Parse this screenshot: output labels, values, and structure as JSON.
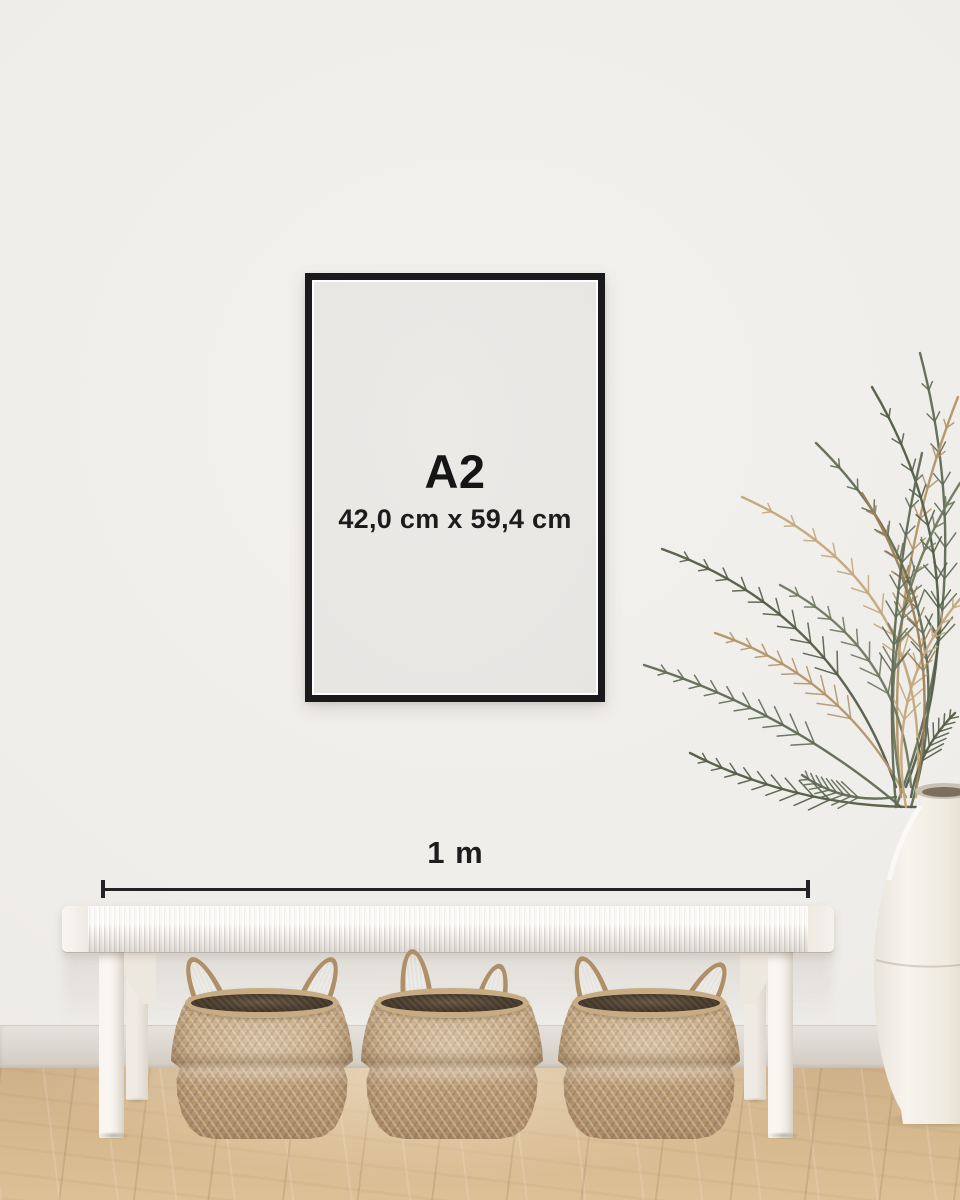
{
  "poster": {
    "format": "A2",
    "dimensions": "42,0 cm x 59,4 cm"
  },
  "ruler": {
    "label": "1 m"
  },
  "colors": {
    "frame": "#1a1a1c",
    "text": "#1a1a1a",
    "ruler_line": "#232325",
    "wall": "#f0eeea",
    "baseboard": "#dcd7d0",
    "floor_wood": "#d5b88e",
    "bench_white": "#f3f0ea",
    "basket_tan": "#c5a67f",
    "palm_green": "#5f6a54",
    "palm_dry": "#b2936a",
    "vase_white": "#f3efe8"
  }
}
